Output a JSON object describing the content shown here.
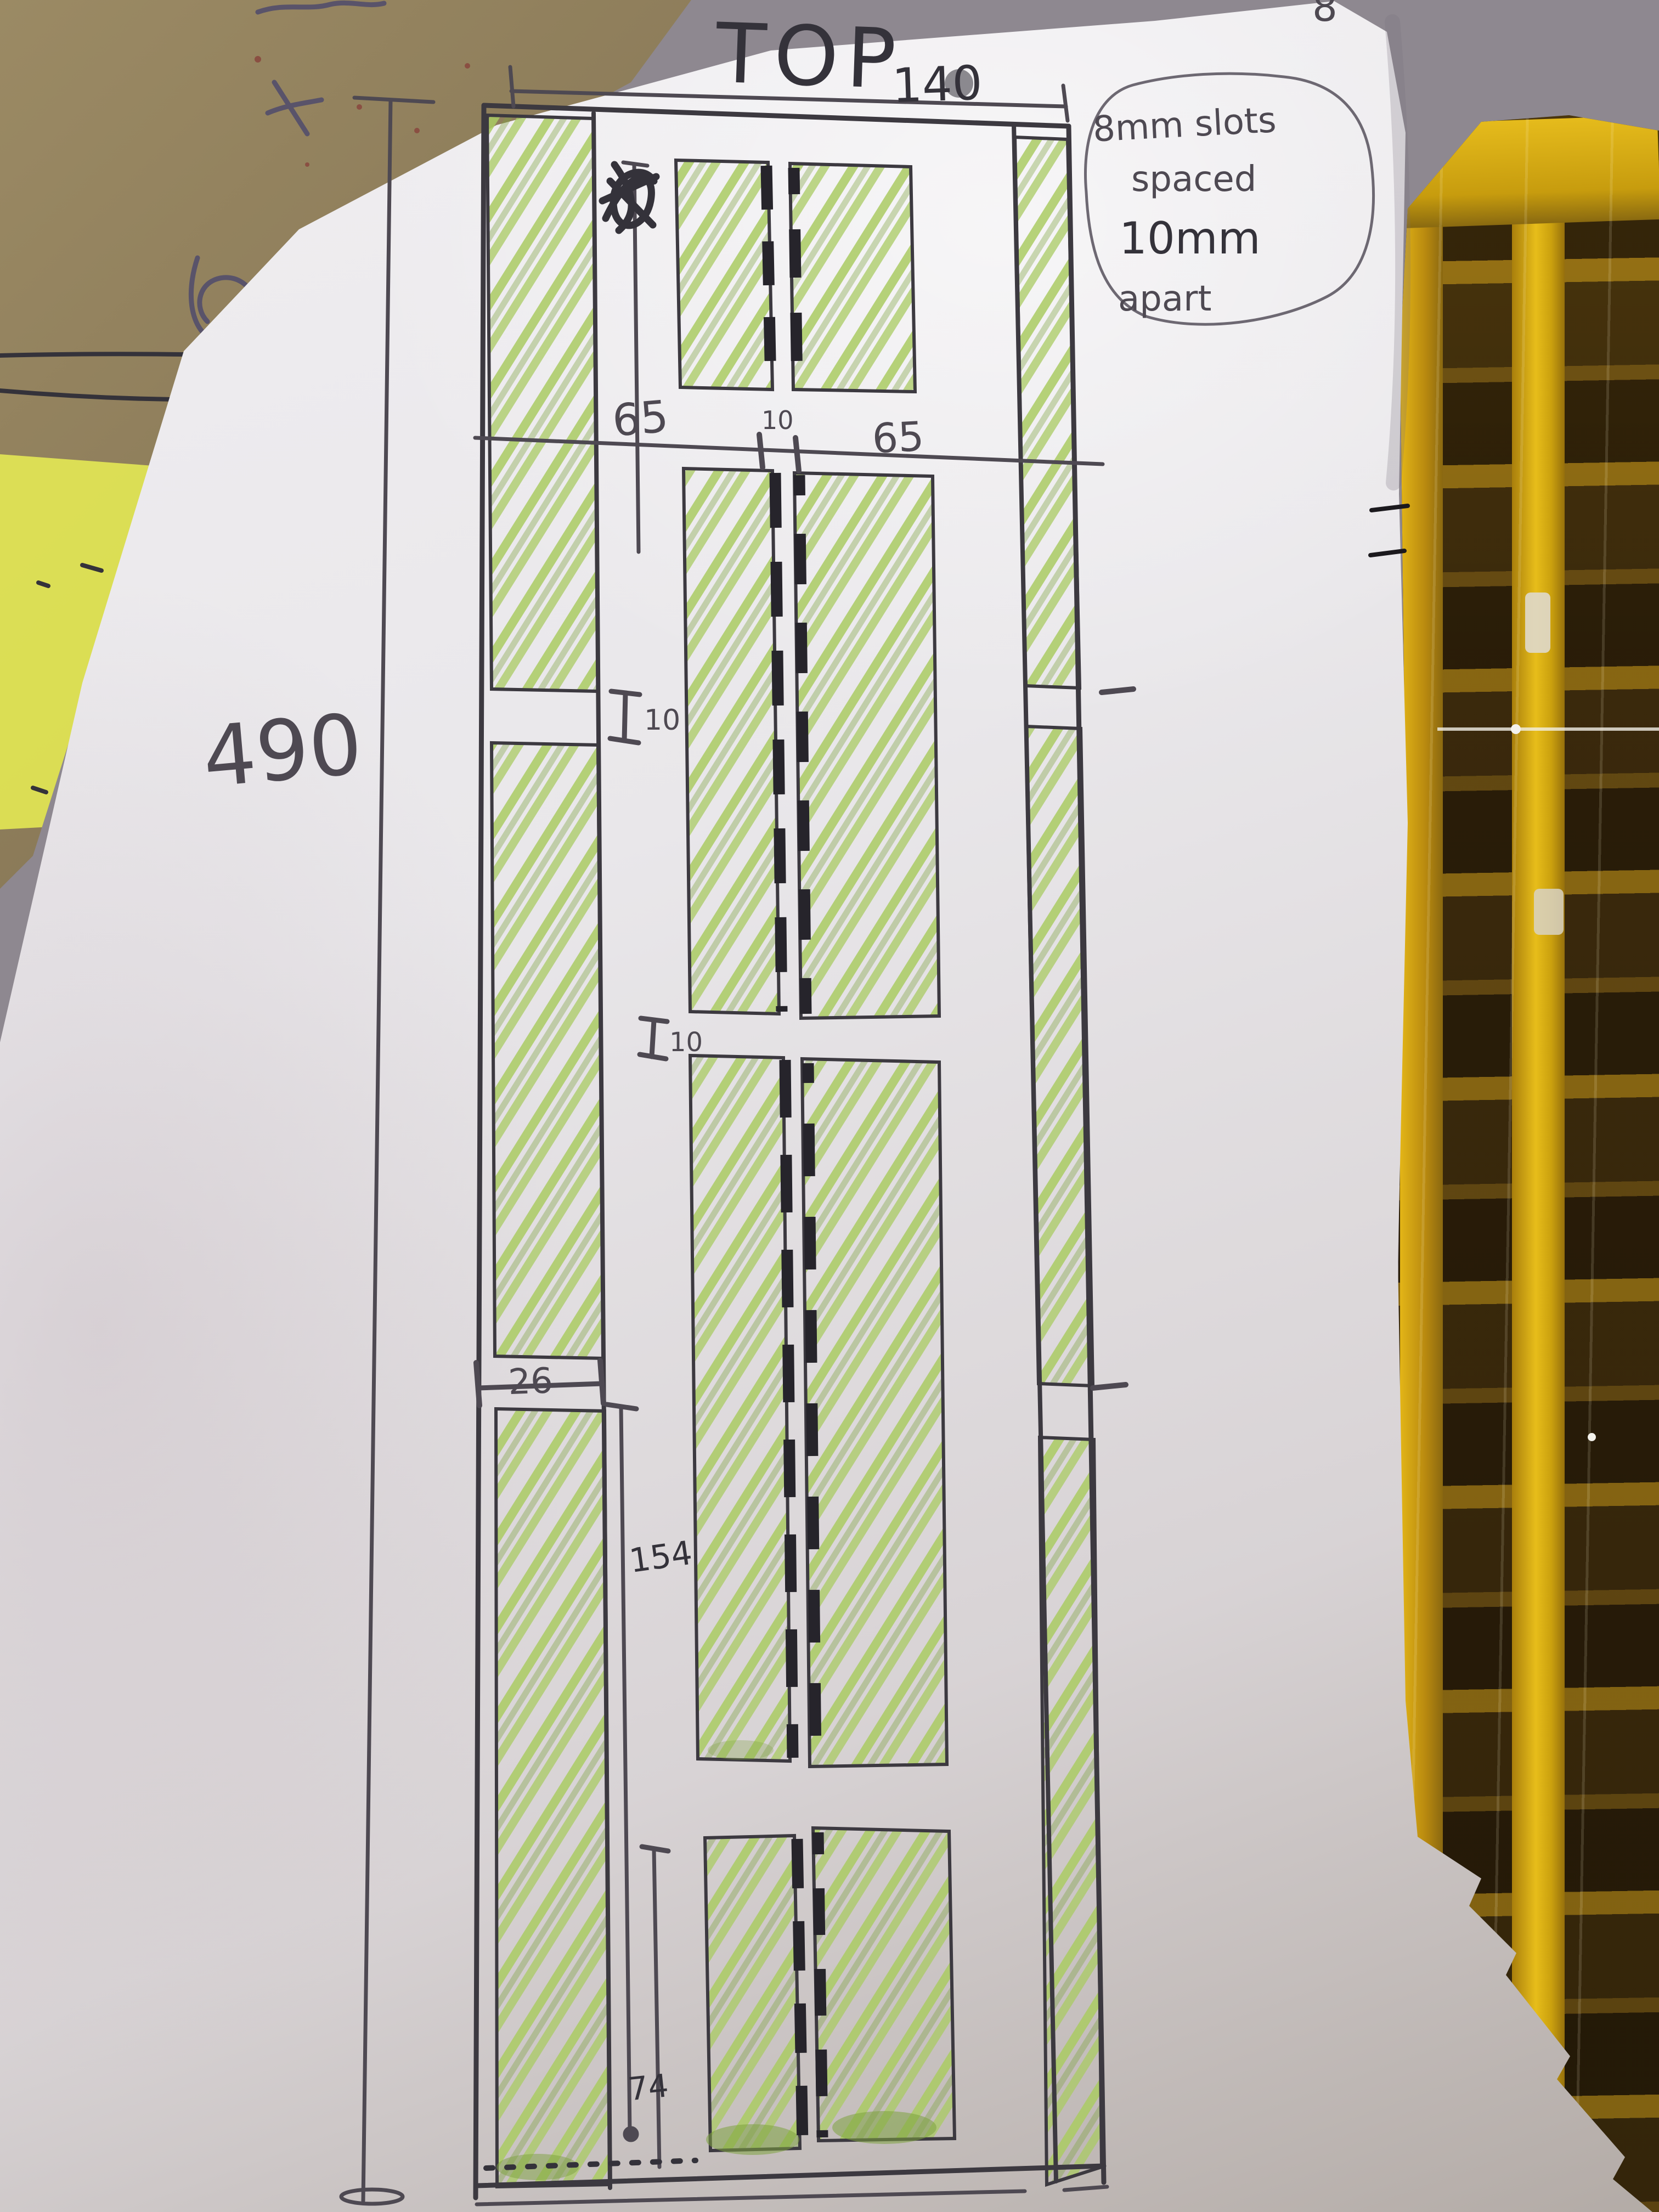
{
  "labels": {
    "title": "TOP",
    "overall_width": "140",
    "overall_height": "490",
    "col_left": "65",
    "col_center_gap": "10",
    "col_right": "65",
    "left_strip_gap": "10",
    "center_section_gap": "10",
    "left_strip_width": "26",
    "section_height": "154",
    "bottom_section_height": "74",
    "stray_mark": "8"
  },
  "note": {
    "lines": [
      "8mm slots",
      "spaced",
      "10mm",
      "apart"
    ]
  },
  "colors": {
    "pencil": "#4e4952",
    "ink": "#34323a",
    "marker": "#3c3940",
    "slot": "#26242b",
    "green": "#aacb62",
    "green2": "#7da23f",
    "highlighter": "#e9ef54",
    "gold": "#d3a410",
    "background": "#b2acb2"
  }
}
